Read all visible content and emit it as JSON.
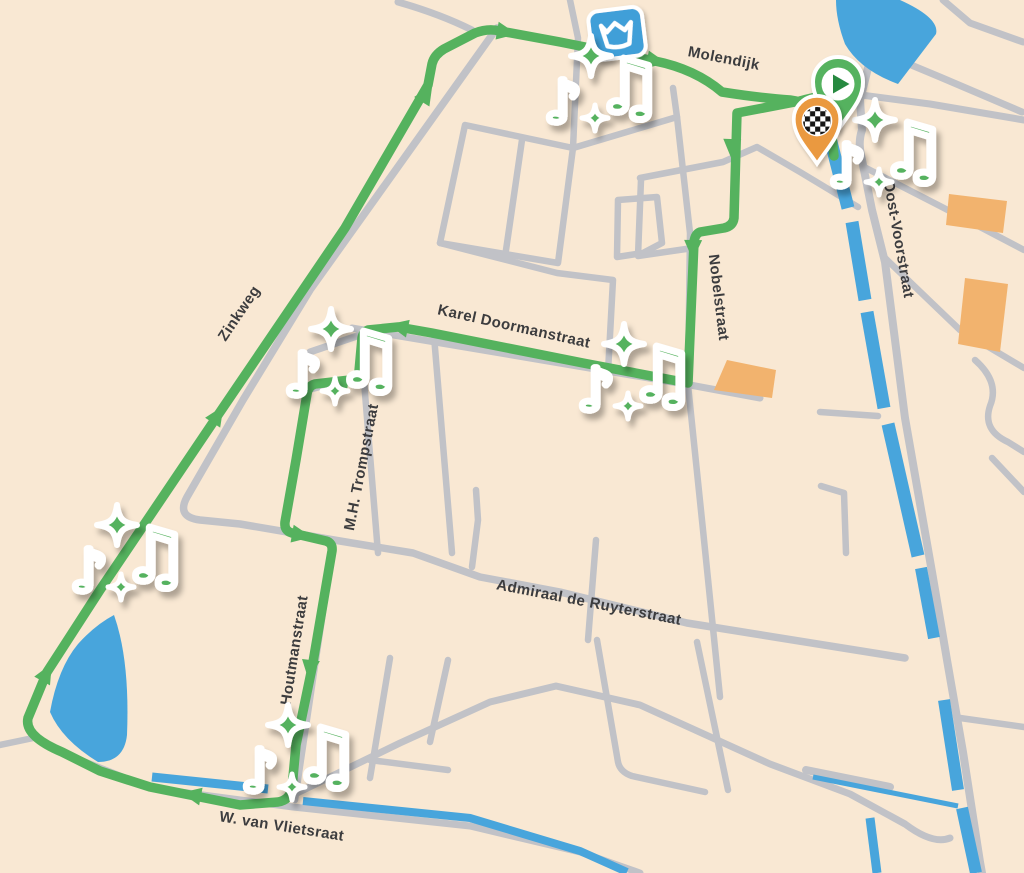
{
  "map": {
    "type": "walking-route-map",
    "description": "Town route map with music waypoints, start and finish markers"
  },
  "streets": [
    {
      "name": "Molendijk"
    },
    {
      "name": "Oost-Voorstraat"
    },
    {
      "name": "Zinkweg"
    },
    {
      "name": "Karel Doormanstraat"
    },
    {
      "name": "Nobelstraat"
    },
    {
      "name": "M.H. Trompstraat"
    },
    {
      "name": "Admiraal de Ruyterstraat"
    },
    {
      "name": "Houtmanstraat"
    },
    {
      "name": "W. van Vlietsraat"
    }
  ],
  "markers": {
    "start": "route-start-play-marker",
    "finish": "route-finish-checkered-marker",
    "landmark": "mill-crown-landmark",
    "music_stop_count": 6,
    "music_stop_glyphs": "♪ ♫ + sparkles"
  },
  "route": {
    "direction_arrows": 12,
    "color": "#55b25e"
  },
  "colors": {
    "background": "#f9e8d3",
    "road": "#c1c2c7",
    "water": "#48a5dc",
    "route_green": "#55b25e",
    "play_green": "#28893f",
    "building_orange": "#f2b36e",
    "marker_orange": "#ea9940",
    "landmark_blue": "#3f9fd8",
    "label": "#3c3c3e"
  }
}
